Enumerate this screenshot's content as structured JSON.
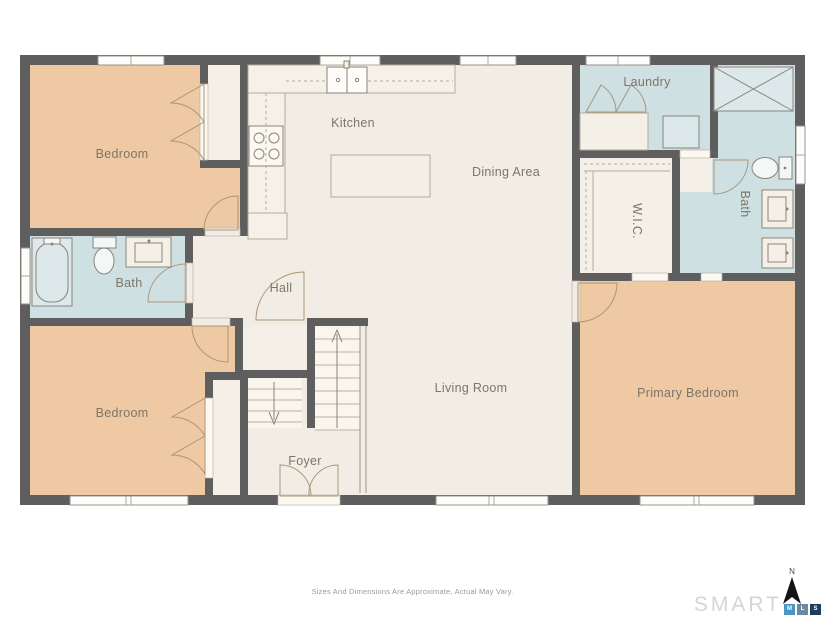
{
  "floor_plan": {
    "room_labels": [
      {
        "text": "Bedroom"
      },
      {
        "text": "Kitchen"
      },
      {
        "text": "Dining Area"
      },
      {
        "text": "Laundry"
      },
      {
        "text": "Bath"
      },
      {
        "text": "W.I.C."
      },
      {
        "text": "Bath"
      },
      {
        "text": "Hall"
      },
      {
        "text": "Bedroom"
      },
      {
        "text": "Living Room"
      },
      {
        "text": "Primary Bedroom"
      },
      {
        "text": "Foyer"
      }
    ],
    "fixtures": [
      "stove",
      "kitchen-sink",
      "kitchen-island",
      "bathtub",
      "toilet",
      "vanity-sink",
      "shower",
      "washer-dryer-closet",
      "stairs-up",
      "stairs-down",
      "entry-double-door",
      "closet-bifold-doors",
      "walk-in-closet-rods"
    ],
    "colors": {
      "wall": "#5e5e5e",
      "floor": "#f2ede4",
      "bedroom_fill": "#eec9a3",
      "wet_room_fill": "#cfe0e3",
      "closet_fill": "#f5f0e7",
      "door_stroke": "#ab9678",
      "fixture_stroke": "#8a8478",
      "counter_stroke": "#b3aa9b"
    }
  },
  "footer": {
    "disclaimer": "Sizes And Dimensions Are Approximate, Actual May Vary.",
    "logo_text": "SMART",
    "logo_badges": [
      {
        "letter": "M",
        "color": "#4796c4"
      },
      {
        "letter": "L",
        "color": "#6d89a0"
      },
      {
        "letter": "S",
        "color": "#1d3d5c"
      }
    ],
    "compass_label": "N"
  }
}
